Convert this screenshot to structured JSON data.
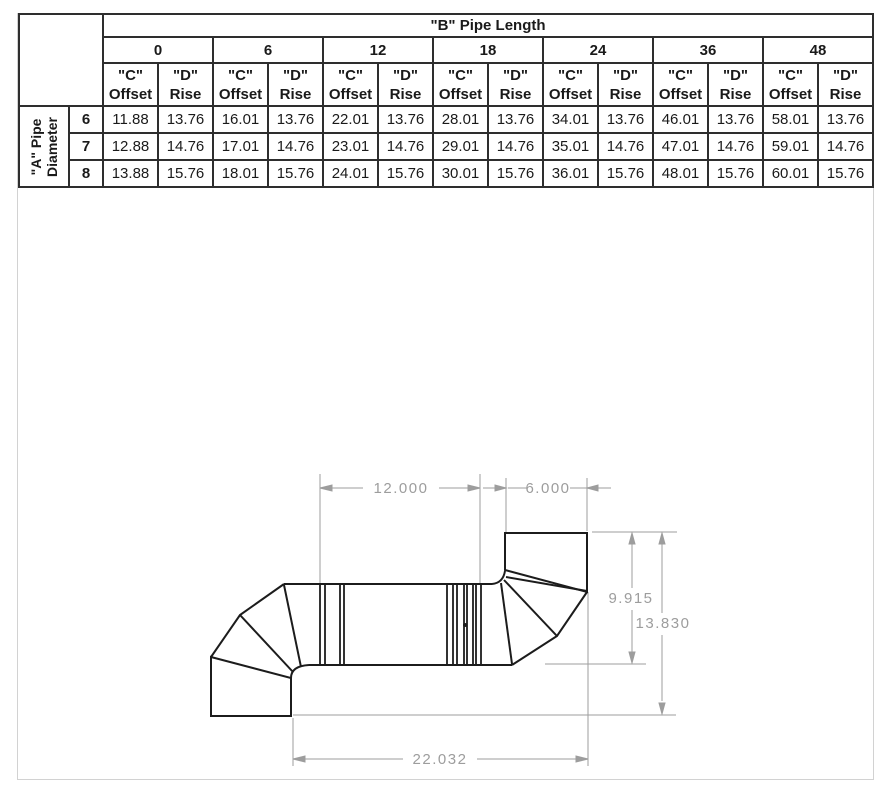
{
  "page": {
    "background": "#ffffff",
    "frame_color": "#d2d2d2",
    "table_border_color": "#2e2e2e",
    "drawing_line_color": "#1c1c1c",
    "dimension_color": "#9d9d9d"
  },
  "table": {
    "title": "\"B\" Pipe Length",
    "row_axis_label_line1": "\"A\" Pipe",
    "row_axis_label_line2": "Diameter",
    "pipe_lengths": [
      "0",
      "6",
      "12",
      "18",
      "24",
      "36",
      "48"
    ],
    "col_pair_header": {
      "c_line1": "\"C\"",
      "c_line2": "Offset",
      "d_line1": "\"D\"",
      "d_line2": "Rise"
    },
    "rows": [
      {
        "diameter": "6",
        "values": [
          "11.88",
          "13.76",
          "16.01",
          "13.76",
          "22.01",
          "13.76",
          "28.01",
          "13.76",
          "34.01",
          "13.76",
          "46.01",
          "13.76",
          "58.01",
          "13.76"
        ]
      },
      {
        "diameter": "7",
        "values": [
          "12.88",
          "14.76",
          "17.01",
          "14.76",
          "23.01",
          "14.76",
          "29.01",
          "14.76",
          "35.01",
          "14.76",
          "47.01",
          "14.76",
          "59.01",
          "14.76"
        ]
      },
      {
        "diameter": "8",
        "values": [
          "13.88",
          "15.76",
          "18.01",
          "15.76",
          "24.01",
          "15.76",
          "30.01",
          "15.76",
          "36.01",
          "15.76",
          "48.01",
          "15.76",
          "60.01",
          "15.76"
        ]
      }
    ]
  },
  "drawing": {
    "dimensions": {
      "straight_pipe_length": "12.000",
      "top_stub_length": "6.000",
      "rise_to_pipe_bottom": "9.915",
      "total_rise": "13.830",
      "total_offset": "22.032"
    }
  }
}
